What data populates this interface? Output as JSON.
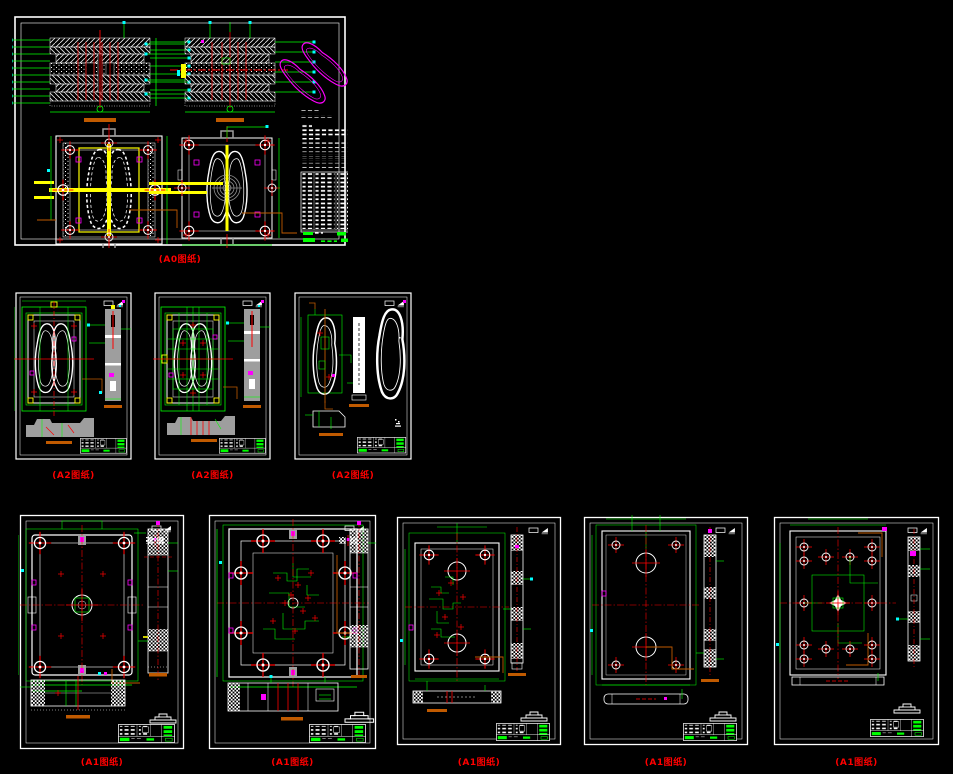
{
  "page": {
    "background": "#000000",
    "description": "Montage of injection mould CAD drawing sheets on black model space"
  },
  "palette": {
    "line_green": "#00ff00",
    "line_red": "#ff0000",
    "line_white": "#ffffff",
    "line_magenta": "#ff00ff",
    "line_cyan": "#00ffff",
    "line_yellow": "#ffff00",
    "line_orange": "#c05a00",
    "fill_gray": "#9e9e9e",
    "label_color": "#ff0000"
  },
  "sheets": [
    {
      "id": "a0-assembly",
      "paper": "A0",
      "label": "(A0图纸)"
    },
    {
      "id": "a2-moving-half",
      "paper": "A2",
      "label": "(A2图纸)"
    },
    {
      "id": "a2-fixed-half",
      "paper": "A2",
      "label": "(A2图纸)"
    },
    {
      "id": "a2-part-views",
      "paper": "A2",
      "label": "(A2图纸)"
    },
    {
      "id": "a1-plate-1",
      "paper": "A1",
      "label": "(A1图纸)"
    },
    {
      "id": "a1-plate-2",
      "paper": "A1",
      "label": "(A1图纸)"
    },
    {
      "id": "a1-plate-3",
      "paper": "A1",
      "label": "(A1图纸)"
    },
    {
      "id": "a1-plate-4",
      "paper": "A1",
      "label": "(A1图纸)"
    },
    {
      "id": "a1-plate-5",
      "paper": "A1",
      "label": "(A1图纸)"
    }
  ]
}
